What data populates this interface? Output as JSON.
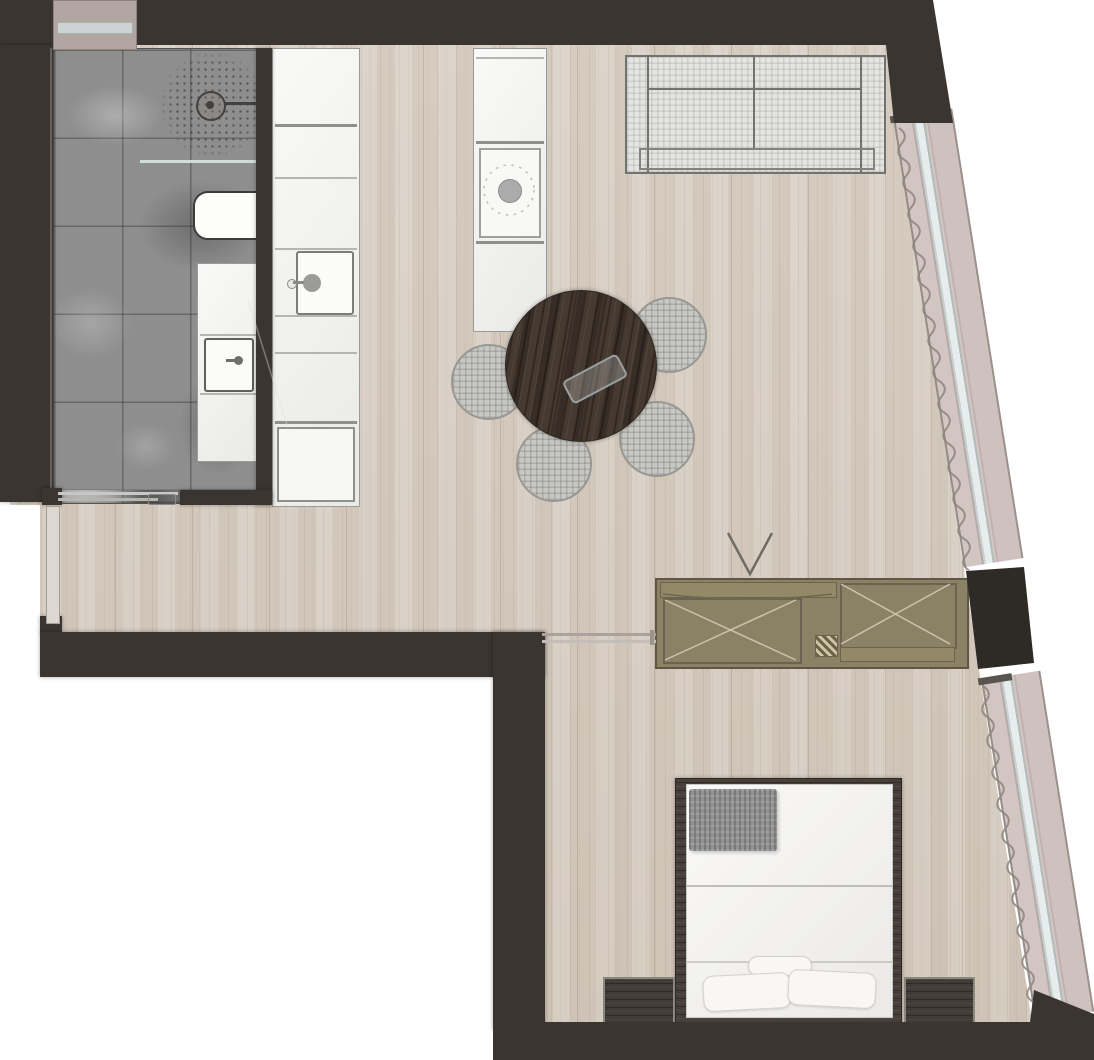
{
  "meta": {
    "title": "apartment-floor-plan",
    "view": "top-down rendered architectural plan",
    "canvas_px": {
      "width": 1094,
      "height": 1060
    },
    "visible_text": "none"
  },
  "palette": {
    "outside": "#ffffff",
    "wall": "#3a3531",
    "floor_base": "#d8cfc3",
    "tile_base": "#8e8e8e",
    "counter": "#f3f3f1",
    "counter_line": "#9a9a98",
    "sofa_fill": "#e4e4e2",
    "sofa_line": "#72726e",
    "chair_fill": "#c6c7c5",
    "chair_line": "#90918f",
    "table_wood": "#463a30",
    "wardrobe_fill": "#8b8165",
    "wardrobe_line": "#5e5744",
    "pier": "#2e2a26",
    "window_band": "#cfc1bd",
    "window_glass": "#e7edec",
    "window_frame": "#9b918d",
    "curtain": "#8b857f",
    "bed_frame": "#473f39",
    "bedding": "#f5f4f2",
    "blanket": "#919191",
    "nightstand": "#423b36",
    "shaft": "#b2a6a2",
    "shaft_band": "#ccd3d2",
    "door_leaf": "#ded7d1",
    "fixture_line": "#44403d"
  },
  "rooms": [
    {
      "name": "bathroom",
      "floor": "gray marble tile",
      "fixtures": [
        "shower-head",
        "shower-spray-area",
        "shower-glass-screen",
        "toilet",
        "vanity-counter",
        "vanity-sink",
        "bathroom-sliding-door"
      ]
    },
    {
      "name": "kitchen",
      "floor": "light wood plank",
      "fixtures": [
        "wall-counter-run",
        "kitchen-sink",
        "kitchen-faucet",
        "oven",
        "island-counter",
        "cooktop",
        "cooktop-burner"
      ]
    },
    {
      "name": "living-dining",
      "floor": "light wood plank",
      "furniture": [
        "sofa",
        "round-dining-table",
        "serving-tray",
        "dining-chairs x4",
        "wardrobe-tv-unit",
        "tv-position-mark"
      ]
    },
    {
      "name": "bedroom",
      "floor": "light wood plank",
      "furniture": [
        "double-bed",
        "folded-blanket",
        "pillows x3",
        "nightstand x2",
        "bedroom-sliding-door"
      ]
    },
    {
      "name": "entry",
      "features": [
        "entry-door-opening",
        "service-shaft"
      ]
    }
  ],
  "windows": {
    "count": 2,
    "style": "slanted floor-to-ceiling glazing band on right edge, ~9 degrees",
    "curtain_symbol": "wavy line along interior side",
    "pier": "dark structural column between the two bands"
  },
  "walls": {
    "style": "thick dark charcoal poche"
  }
}
